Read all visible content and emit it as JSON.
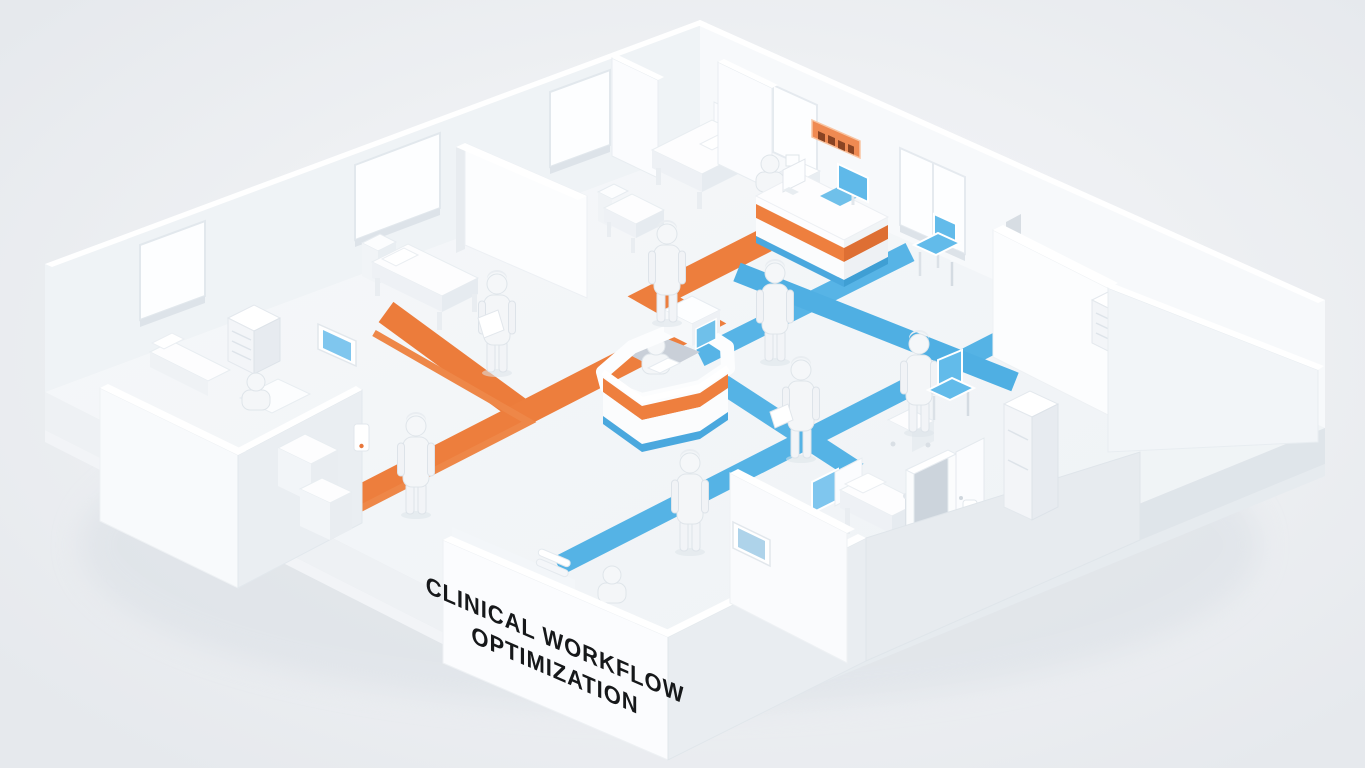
{
  "scene": {
    "title_lines": [
      "CLINICAL WORKFLOW",
      "OPTIMIZATION"
    ],
    "title_full": "CLINICAL WORKFLOW OPTIMIZATION"
  },
  "wall_sign": {
    "color": "#ef8a52",
    "legible": false,
    "text": ""
  },
  "colors": {
    "background": "#eef0f3",
    "floor": "#f3f6f8",
    "wall_bright": "#fafcfd",
    "wall_shade": "#e8edf1",
    "orange_route": "#ec7c3b",
    "orange_accent": "#ee8748",
    "blue_route": "#55b3e5",
    "chair_blue": "#60baea",
    "screen_blue": "#7fc6ee",
    "title_text": "#16181a",
    "sign_orange": "#ef8a52"
  },
  "routes": {
    "orange": {
      "color": "#ec7c3b",
      "style": "wide floor band with thin parallel accent stripe",
      "segments": 4
    },
    "blue": {
      "color": "#55b3e5",
      "style": "criss-crossing floor bands",
      "segments": 4
    }
  },
  "rooms": [
    {
      "name": "patient-bay-upper-left-1"
    },
    {
      "name": "patient-bay-upper-left-2"
    },
    {
      "name": "patient-room-top-center"
    },
    {
      "name": "reception-area"
    },
    {
      "name": "exam-room-right"
    },
    {
      "name": "office-room-left"
    },
    {
      "name": "consult-room-bottom-center"
    },
    {
      "name": "ward-room-bottom-right"
    }
  ],
  "figures": [
    {
      "name": "nurse-with-clipboard"
    },
    {
      "name": "doctor-on-orange-route"
    },
    {
      "name": "doctor-beside-station"
    },
    {
      "name": "clinician-with-document"
    },
    {
      "name": "clinician-at-cart"
    },
    {
      "name": "nurse-on-blue-route"
    },
    {
      "name": "doctor-near-left-room"
    },
    {
      "name": "clerk-seated-left-room"
    },
    {
      "name": "receptionist-at-desk"
    },
    {
      "name": "nurse-seated-central-station"
    },
    {
      "name": "patient-behind-front-wall"
    }
  ],
  "furniture": {
    "desks": [
      "central-nurse-station",
      "reception-desk"
    ],
    "beds": 5,
    "chairs": [
      "waiting-chair-reception",
      "waiting-chair-corridor"
    ],
    "cabinets": [
      "drawer-unit-left-room",
      "drawer-unit-right-room",
      "tall-cabinet-bottom-right",
      "copier-machine-left"
    ],
    "monitors": [
      "wall-monitor-left-room",
      "wall-monitor-corridor",
      "bed-head-screen",
      "reception-sign-board",
      "station-terminal"
    ],
    "dispensers": 2,
    "windows": 6
  }
}
